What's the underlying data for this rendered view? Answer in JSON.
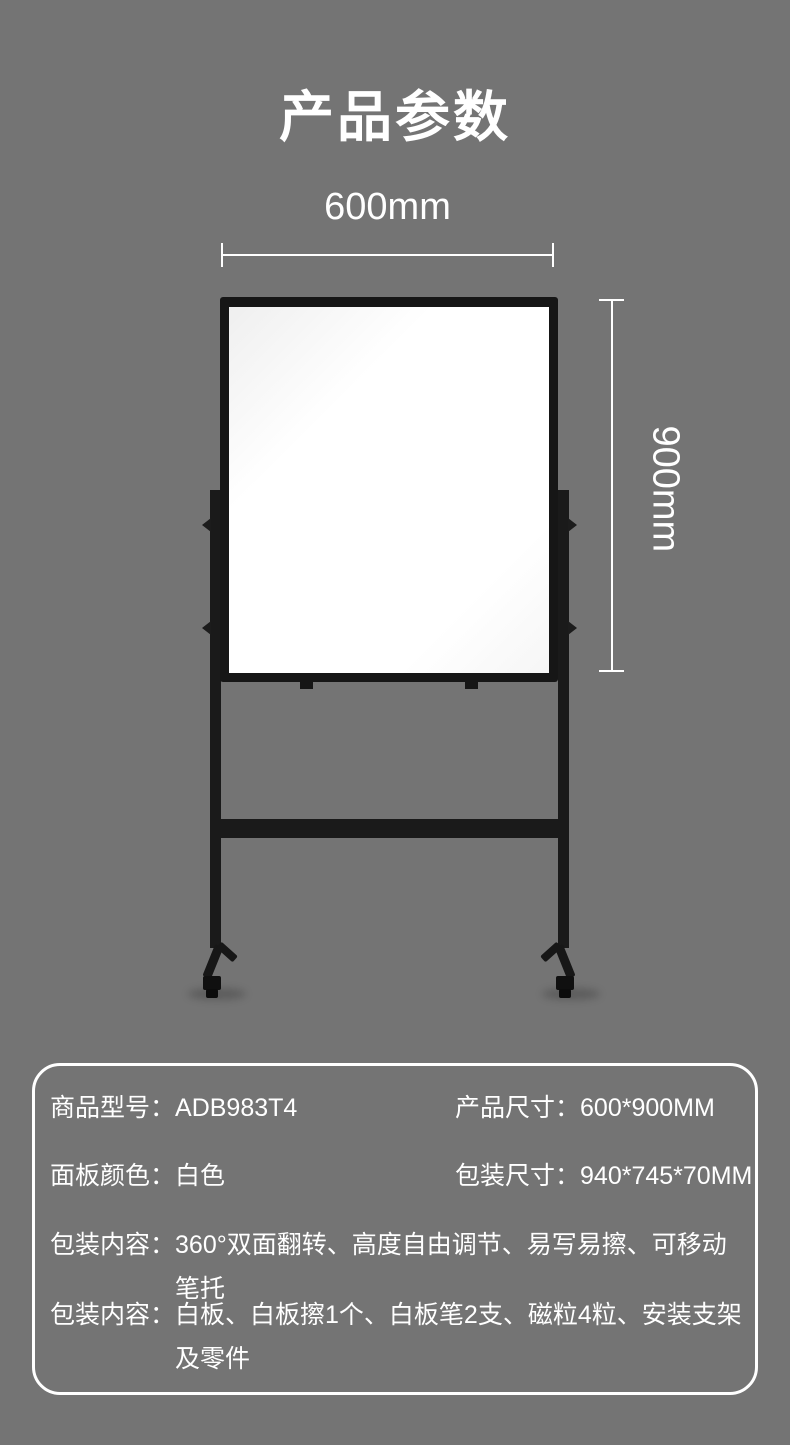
{
  "page": {
    "title": "产品参数",
    "background_color": "#747474",
    "text_color": "#ffffff"
  },
  "diagram": {
    "width_label": "600mm",
    "height_label": "900mm",
    "frame_color": "#161616",
    "panel_color": "#ffffff"
  },
  "spec_card": {
    "border_color": "#ffffff",
    "rows": [
      {
        "label": "商品型号：",
        "value": "ADB983T4"
      },
      {
        "label": "产品尺寸：",
        "value": "600*900MM"
      },
      {
        "label": "面板颜色：",
        "value": "白色"
      },
      {
        "label": "包装尺寸：",
        "value": "940*745*70MM"
      },
      {
        "label": "包装内容：",
        "value": "360°双面翻转、高度自由调节、易写易擦、可移动笔托"
      },
      {
        "label": "包装内容：",
        "value": "白板、白板擦1个、白板笔2支、磁粒4粒、安装支架及零件"
      }
    ]
  }
}
